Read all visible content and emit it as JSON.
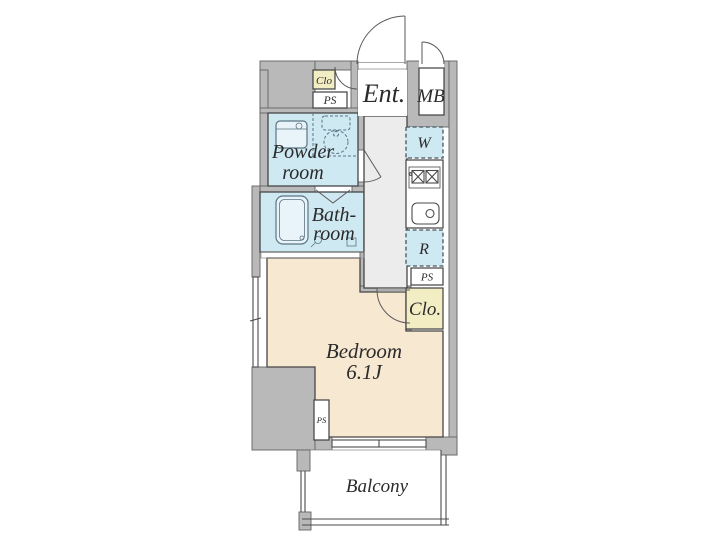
{
  "plan": {
    "type": "apartment-floor-plan",
    "rooms": {
      "entrance": {
        "label": "Ent."
      },
      "meter_box": {
        "label": "MB"
      },
      "closet_entrance": {
        "label": "Clo"
      },
      "pipe_space_entrance": {
        "label": "PS"
      },
      "powder_room": {
        "line1": "Powder",
        "line2": "room"
      },
      "bathroom": {
        "line1": "Bath-",
        "line2": "room"
      },
      "washer_space": {
        "label": "W"
      },
      "refrigerator_space": {
        "label": "R"
      },
      "pipe_space_kitchen": {
        "label": "PS"
      },
      "closet_bedroom": {
        "label": "Clo."
      },
      "bedroom": {
        "label": "Bedroom",
        "size": "6.1J"
      },
      "pipe_space_bedroom": {
        "label": "PS"
      },
      "balcony": {
        "label": "Balcony"
      }
    }
  },
  "colors": {
    "wall": "#b9b9b9",
    "wet_area": "#cfe9f2",
    "fixture": "#e9f4fa",
    "closet": "#f3edc4",
    "bedroom": "#f7e8d1",
    "corridor": "#ececec",
    "floor_white": "#ffffff",
    "outline": "#4a4a4a",
    "text": "#2b2b2b"
  }
}
